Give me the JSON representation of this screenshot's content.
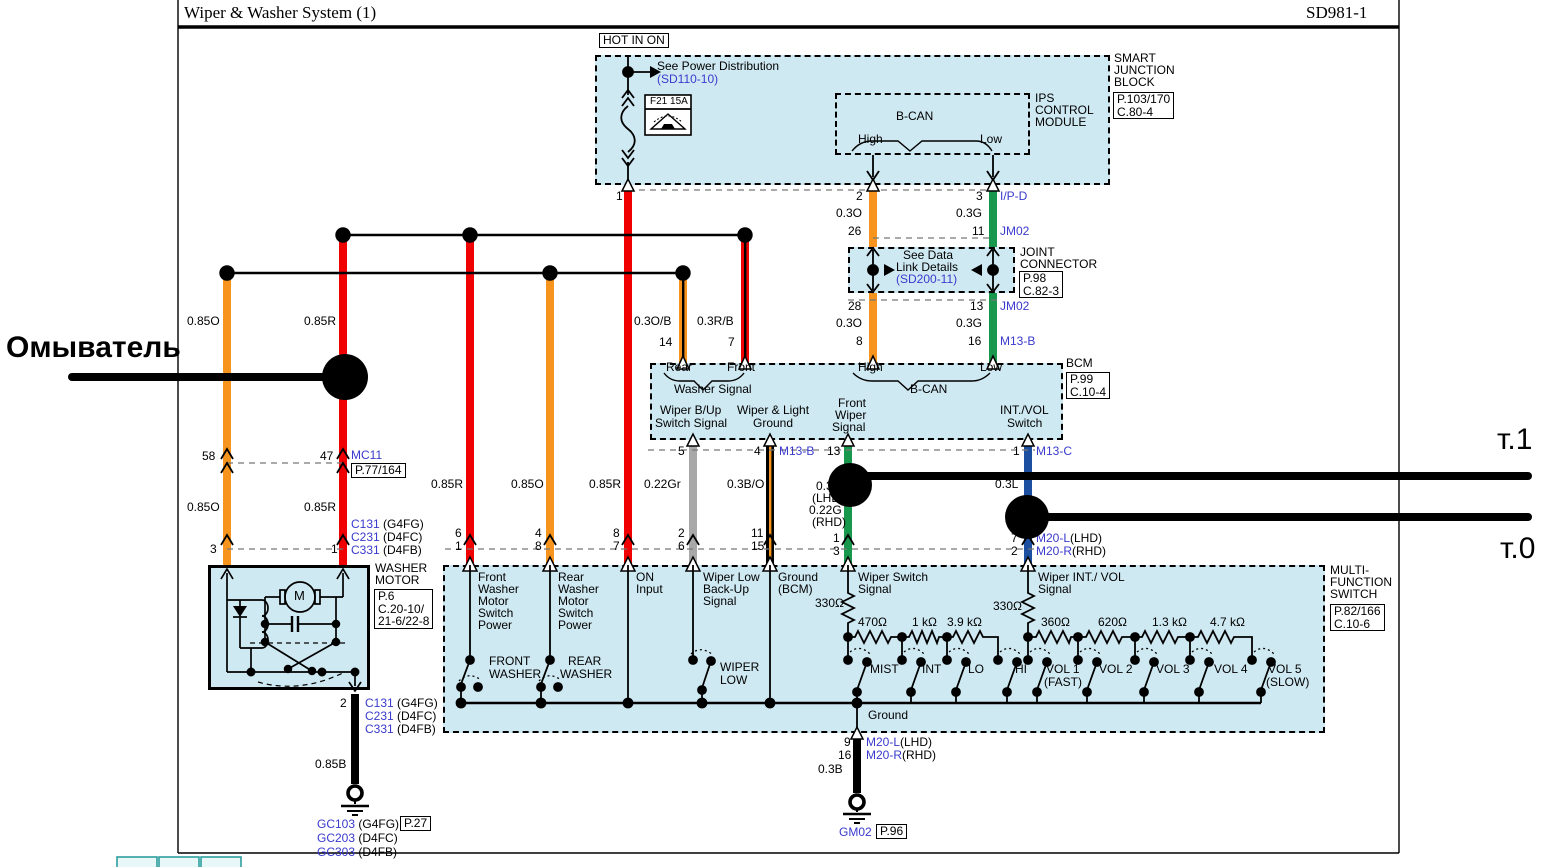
{
  "title": {
    "left": "Wiper & Washer System (1)",
    "right": "SD981-1"
  },
  "colors": {
    "wire_red": "#f00000",
    "wire_orange": "#f7941d",
    "wire_green": "#17984c",
    "wire_blue": "#1d4fa1",
    "wire_gray": "#a8a8a8",
    "wire_black": "#000000",
    "module_fill": "#cfe9f2",
    "link_blue": "#3a3acd",
    "annotation_black": "#000000",
    "teal_tab": "#2f9e9e"
  },
  "labels": [
    {
      "name": "washer-annotation",
      "text": "Омыватель",
      "x": 6,
      "y": 332,
      "size": 30,
      "bold": true
    },
    {
      "name": "t1-annotation",
      "text": "т.1",
      "x": 1497,
      "y": 424,
      "size": 30
    },
    {
      "name": "t0-annotation",
      "text": "т.0",
      "x": 1500,
      "y": 533,
      "size": 30
    },
    {
      "name": "hot-in-on-label",
      "text": "HOT IN ON",
      "x": 599,
      "y": 33,
      "boxed": true
    },
    {
      "name": "see-power-distribution",
      "text": "See Power Distribution",
      "x": 657,
      "y": 60
    },
    {
      "name": "see-power-ref",
      "text": "(SD110-10)",
      "x": 657,
      "y": 73,
      "color": "blue"
    },
    {
      "name": "fuse-label",
      "text": "F21 15A",
      "x": 650,
      "y": 97,
      "size": 10
    },
    {
      "name": "sjb-name-1",
      "text": "SMART",
      "x": 1114,
      "y": 52
    },
    {
      "name": "sjb-name-2",
      "text": "JUNCTION",
      "x": 1114,
      "y": 64
    },
    {
      "name": "sjb-name-3",
      "text": "BLOCK",
      "x": 1114,
      "y": 76
    },
    {
      "name": "sjb-ref",
      "lines": [
        "P.103/170",
        "C.80-4"
      ],
      "x": 1113,
      "y": 92,
      "boxed": true
    },
    {
      "name": "ips-name-1",
      "text": "IPS",
      "x": 1035,
      "y": 92
    },
    {
      "name": "ips-name-2",
      "text": "CONTROL",
      "x": 1035,
      "y": 104
    },
    {
      "name": "ips-name-3",
      "text": "MODULE",
      "x": 1035,
      "y": 116
    },
    {
      "name": "bcan-top",
      "text": "B-CAN",
      "x": 896,
      "y": 110
    },
    {
      "name": "high-top",
      "text": "High",
      "x": 858,
      "y": 133
    },
    {
      "name": "low-top",
      "text": "Low",
      "x": 980,
      "y": 133
    },
    {
      "name": "pin",
      "text": "1",
      "x": 616,
      "y": 190
    },
    {
      "name": "pin",
      "text": "2",
      "x": 856,
      "y": 190
    },
    {
      "name": "wire-label",
      "text": "0.3O",
      "x": 836,
      "y": 207
    },
    {
      "name": "pin",
      "text": "26",
      "x": 848,
      "y": 225
    },
    {
      "name": "pin",
      "text": "3",
      "x": 976,
      "y": 190
    },
    {
      "name": "connector-ref",
      "text": "I/P-D",
      "x": 1000,
      "y": 190,
      "color": "blue"
    },
    {
      "name": "wire-label",
      "text": "0.3G",
      "x": 956,
      "y": 207
    },
    {
      "name": "pin",
      "text": "11",
      "x": 972,
      "y": 225
    },
    {
      "name": "connector-ref",
      "text": "JM02",
      "x": 1000,
      "y": 225,
      "color": "blue"
    },
    {
      "name": "jc-text-1",
      "text": "See Data",
      "x": 903,
      "y": 249
    },
    {
      "name": "jc-text-2",
      "text": "Link Details",
      "x": 896,
      "y": 261
    },
    {
      "name": "jc-ref-link",
      "text": "(SD200-11)",
      "x": 896,
      "y": 273,
      "color": "blue"
    },
    {
      "name": "jc-name-1",
      "text": "JOINT",
      "x": 1020,
      "y": 246
    },
    {
      "name": "jc-name-2",
      "text": "CONNECTOR",
      "x": 1020,
      "y": 258
    },
    {
      "name": "jc-ref",
      "lines": [
        "P.98",
        "C.82-3"
      ],
      "x": 1019,
      "y": 271,
      "boxed": true
    },
    {
      "name": "pin",
      "text": "28",
      "x": 848,
      "y": 300
    },
    {
      "name": "wire-label",
      "text": "0.3O",
      "x": 836,
      "y": 317
    },
    {
      "name": "pin",
      "text": "8",
      "x": 856,
      "y": 335
    },
    {
      "name": "pin",
      "text": "13",
      "x": 970,
      "y": 300
    },
    {
      "name": "connector-ref",
      "text": "JM02",
      "x": 1000,
      "y": 300,
      "color": "blue"
    },
    {
      "name": "wire-label",
      "text": "0.3G",
      "x": 956,
      "y": 317
    },
    {
      "name": "pin",
      "text": "16",
      "x": 968,
      "y": 335
    },
    {
      "name": "connector-ref",
      "text": "M13-B",
      "x": 1000,
      "y": 335,
      "color": "blue"
    },
    {
      "name": "wire-label",
      "text": "0.85O",
      "x": 187,
      "y": 315
    },
    {
      "name": "wire-label",
      "text": "0.85R",
      "x": 304,
      "y": 315
    },
    {
      "name": "pin",
      "text": "58",
      "x": 202,
      "y": 450
    },
    {
      "name": "pin",
      "text": "47",
      "x": 320,
      "y": 450
    },
    {
      "name": "connector-ref",
      "text": "MC11",
      "x": 351,
      "y": 449,
      "color": "blue"
    },
    {
      "name": "connector-page-ref",
      "lines": [
        "P.77/164"
      ],
      "x": 351,
      "y": 463,
      "boxed": true
    },
    {
      "name": "wire-label",
      "text": "0.85O",
      "x": 187,
      "y": 501
    },
    {
      "name": "wire-label",
      "text": "0.85R",
      "x": 304,
      "y": 501
    },
    {
      "name": "pin",
      "text": "3",
      "x": 210,
      "y": 543
    },
    {
      "name": "pin",
      "text": "1",
      "x": 331,
      "y": 543
    },
    {
      "name": "connector-row",
      "parts": [
        {
          "t": "C131",
          "c": "blue"
        },
        {
          "t": " (G4FG)",
          "c": "black"
        }
      ],
      "x": 351,
      "y": 518
    },
    {
      "name": "connector-row",
      "parts": [
        {
          "t": "C231",
          "c": "blue"
        },
        {
          "t": " (D4FC)",
          "c": "black"
        }
      ],
      "x": 351,
      "y": 531
    },
    {
      "name": "connector-row",
      "parts": [
        {
          "t": "C331",
          "c": "blue"
        },
        {
          "t": " (D4FB)",
          "c": "black"
        }
      ],
      "x": 351,
      "y": 544
    },
    {
      "name": "washer-motor-name-1",
      "text": "WASHER",
      "x": 375,
      "y": 562
    },
    {
      "name": "washer-motor-name-2",
      "text": "MOTOR",
      "x": 375,
      "y": 574
    },
    {
      "name": "washer-motor-ref",
      "lines": [
        "P.6",
        "C.20-10/",
        "21-6/22-8"
      ],
      "x": 374,
      "y": 589,
      "boxed": true
    },
    {
      "name": "motor-m",
      "text": "M",
      "x": 294,
      "y": 589,
      "size": 13
    },
    {
      "name": "pin",
      "text": "2",
      "x": 340,
      "y": 697
    },
    {
      "name": "connector-row",
      "parts": [
        {
          "t": "C131",
          "c": "blue"
        },
        {
          "t": " (G4FG)",
          "c": "black"
        }
      ],
      "x": 365,
      "y": 697
    },
    {
      "name": "connector-row",
      "parts": [
        {
          "t": "C231",
          "c": "blue"
        },
        {
          "t": " (D4FC)",
          "c": "black"
        }
      ],
      "x": 365,
      "y": 710
    },
    {
      "name": "connector-row",
      "parts": [
        {
          "t": "C331",
          "c": "blue"
        },
        {
          "t": " (D4FB)",
          "c": "black"
        }
      ],
      "x": 365,
      "y": 723
    },
    {
      "name": "wire-label",
      "text": "0.85B",
      "x": 315,
      "y": 758
    },
    {
      "name": "ground-row",
      "parts": [
        {
          "t": "GC103",
          "c": "blue"
        },
        {
          "t": " (G4FG)",
          "c": "black"
        }
      ],
      "x": 317,
      "y": 818
    },
    {
      "name": "ground-page-ref",
      "lines": [
        "P.27"
      ],
      "x": 400,
      "y": 816,
      "boxed": true
    },
    {
      "name": "ground-row",
      "parts": [
        {
          "t": "GC203",
          "c": "blue"
        },
        {
          "t": " (D4FC)",
          "c": "black"
        }
      ],
      "x": 317,
      "y": 832
    },
    {
      "name": "ground-row",
      "parts": [
        {
          "t": "GC303",
          "c": "blue"
        },
        {
          "t": " (D4FB)",
          "c": "black"
        }
      ],
      "x": 317,
      "y": 846
    },
    {
      "name": "wire-label",
      "text": "0.85R",
      "x": 431,
      "y": 478
    },
    {
      "name": "wire-label",
      "text": "0.85O",
      "x": 511,
      "y": 478
    },
    {
      "name": "wire-label",
      "text": "0.85R",
      "x": 589,
      "y": 478
    },
    {
      "name": "wire-label",
      "text": "0.22Gr",
      "x": 644,
      "y": 478
    },
    {
      "name": "wire-label",
      "text": "0.3B/O",
      "x": 727,
      "y": 478
    },
    {
      "name": "pin",
      "text": "6",
      "x": 455,
      "y": 527
    },
    {
      "name": "pin",
      "text": "1",
      "x": 455,
      "y": 540
    },
    {
      "name": "pin",
      "text": "4",
      "x": 535,
      "y": 527
    },
    {
      "name": "pin",
      "text": "8",
      "x": 535,
      "y": 540
    },
    {
      "name": "pin",
      "text": "8",
      "x": 613,
      "y": 527
    },
    {
      "name": "pin",
      "text": "7",
      "x": 613,
      "y": 540
    },
    {
      "name": "pin",
      "text": "2",
      "x": 678,
      "y": 527
    },
    {
      "name": "pin",
      "text": "6",
      "x": 678,
      "y": 540
    },
    {
      "name": "pin",
      "text": "11",
      "x": 751,
      "y": 527
    },
    {
      "name": "pin",
      "text": "15",
      "x": 751,
      "y": 540
    },
    {
      "name": "pin",
      "text": "5",
      "x": 678,
      "y": 445
    },
    {
      "name": "pin",
      "text": "4",
      "x": 754,
      "y": 445
    },
    {
      "name": "connector-ref",
      "text": "M13-B",
      "x": 779,
      "y": 445,
      "color": "blue"
    },
    {
      "name": "pin",
      "text": "13",
      "x": 827,
      "y": 445
    },
    {
      "name": "pin",
      "text": "1",
      "x": 1013,
      "y": 445
    },
    {
      "name": "connector-ref",
      "text": "M13-C",
      "x": 1036,
      "y": 445,
      "color": "blue"
    },
    {
      "name": "wire-label",
      "text": "0.3G",
      "x": 816,
      "y": 480
    },
    {
      "name": "wire-label",
      "text": "(LHD)",
      "x": 812,
      "y": 492
    },
    {
      "name": "wire-label",
      "text": "0.22G",
      "x": 809,
      "y": 504
    },
    {
      "name": "wire-label",
      "text": "(RHD)",
      "x": 812,
      "y": 516
    },
    {
      "name": "pin",
      "text": "1",
      "x": 833,
      "y": 532
    },
    {
      "name": "pin",
      "text": "3",
      "x": 833,
      "y": 545
    },
    {
      "name": "wire-label",
      "text": "0.3L",
      "x": 995,
      "y": 478
    },
    {
      "name": "pin",
      "text": "7",
      "x": 1011,
      "y": 532
    },
    {
      "name": "pin",
      "text": "2",
      "x": 1011,
      "y": 545
    },
    {
      "name": "connector-row",
      "parts": [
        {
          "t": "M20-L",
          "c": "blue"
        },
        {
          "t": "(LHD)",
          "c": "black"
        }
      ],
      "x": 1036,
      "y": 532
    },
    {
      "name": "connector-row",
      "parts": [
        {
          "t": "M20-R",
          "c": "blue"
        },
        {
          "t": "(RHD)",
          "c": "black"
        }
      ],
      "x": 1036,
      "y": 545
    },
    {
      "name": "wire-label",
      "text": "0.3O/B",
      "x": 634,
      "y": 315
    },
    {
      "name": "pin",
      "text": "14",
      "x": 659,
      "y": 336
    },
    {
      "name": "wire-label",
      "text": "0.3R/B",
      "x": 697,
      "y": 315
    },
    {
      "name": "pin",
      "text": "7",
      "x": 728,
      "y": 336
    },
    {
      "name": "bcm-rear",
      "text": "Rear",
      "x": 666,
      "y": 361
    },
    {
      "name": "bcm-front",
      "text": "Front",
      "x": 727,
      "y": 361
    },
    {
      "name": "bcm-washer-signal",
      "text": "Washer Signal",
      "x": 674,
      "y": 383
    },
    {
      "name": "bcm-high",
      "text": "High",
      "x": 858,
      "y": 361
    },
    {
      "name": "bcm-low",
      "text": "Low",
      "x": 980,
      "y": 361
    },
    {
      "name": "bcm-bcan",
      "text": "B-CAN",
      "x": 910,
      "y": 383
    },
    {
      "name": "bcm-io",
      "text": "Wiper B/Up",
      "x": 660,
      "y": 404
    },
    {
      "name": "bcm-io",
      "text": "Switch Signal",
      "x": 655,
      "y": 417
    },
    {
      "name": "bcm-io",
      "text": "Wiper & Light",
      "x": 737,
      "y": 404
    },
    {
      "name": "bcm-io",
      "text": "Ground",
      "x": 753,
      "y": 417
    },
    {
      "name": "bcm-io",
      "text": "Front",
      "x": 838,
      "y": 397
    },
    {
      "name": "bcm-io",
      "text": "Wiper",
      "x": 835,
      "y": 409
    },
    {
      "name": "bcm-io",
      "text": "Signal",
      "x": 832,
      "y": 421
    },
    {
      "name": "bcm-io",
      "text": "INT./VOL",
      "x": 1000,
      "y": 404
    },
    {
      "name": "bcm-io",
      "text": "Switch",
      "x": 1007,
      "y": 417
    },
    {
      "name": "bcm-name",
      "text": "BCM",
      "x": 1066,
      "y": 357
    },
    {
      "name": "bcm-ref",
      "lines": [
        "P.99",
        "C.10-4"
      ],
      "x": 1066,
      "y": 372,
      "boxed": true
    },
    {
      "name": "mfs-col",
      "text": "Front",
      "x": 478,
      "y": 571
    },
    {
      "name": "mfs-col",
      "text": "Washer",
      "x": 478,
      "y": 583
    },
    {
      "name": "mfs-col",
      "text": "Motor",
      "x": 478,
      "y": 595
    },
    {
      "name": "mfs-col",
      "text": "Switch",
      "x": 478,
      "y": 607
    },
    {
      "name": "mfs-col",
      "text": "Power",
      "x": 478,
      "y": 619
    },
    {
      "name": "mfs-col",
      "text": "Rear",
      "x": 558,
      "y": 571
    },
    {
      "name": "mfs-col",
      "text": "Washer",
      "x": 558,
      "y": 583
    },
    {
      "name": "mfs-col",
      "text": "Motor",
      "x": 558,
      "y": 595
    },
    {
      "name": "mfs-col",
      "text": "Switch",
      "x": 558,
      "y": 607
    },
    {
      "name": "mfs-col",
      "text": "Power",
      "x": 558,
      "y": 619
    },
    {
      "name": "mfs-col",
      "text": "ON",
      "x": 636,
      "y": 571
    },
    {
      "name": "mfs-col",
      "text": "Input",
      "x": 636,
      "y": 583
    },
    {
      "name": "mfs-col",
      "text": "Wiper Low",
      "x": 703,
      "y": 571
    },
    {
      "name": "mfs-col",
      "text": "Back-Up",
      "x": 703,
      "y": 583
    },
    {
      "name": "mfs-col",
      "text": "Signal",
      "x": 703,
      "y": 595
    },
    {
      "name": "mfs-col",
      "text": "Ground",
      "x": 778,
      "y": 571
    },
    {
      "name": "mfs-col",
      "text": "(BCM)",
      "x": 778,
      "y": 583
    },
    {
      "name": "mfs-col",
      "text": "Wiper Switch",
      "x": 858,
      "y": 571
    },
    {
      "name": "mfs-col",
      "text": "Signal",
      "x": 858,
      "y": 583
    },
    {
      "name": "mfs-col",
      "text": "Wiper INT./ VOL",
      "x": 1038,
      "y": 571
    },
    {
      "name": "mfs-col",
      "text": "Signal",
      "x": 1038,
      "y": 583
    },
    {
      "name": "resistor-value",
      "text": "330Ω",
      "x": 815,
      "y": 597
    },
    {
      "name": "resistor-value",
      "text": "330Ω",
      "x": 993,
      "y": 600
    },
    {
      "name": "resistor-value",
      "text": "470Ω",
      "x": 858,
      "y": 616
    },
    {
      "name": "resistor-value",
      "text": "1 kΩ",
      "x": 912,
      "y": 616
    },
    {
      "name": "resistor-value",
      "text": "3.9 kΩ",
      "x": 947,
      "y": 616
    },
    {
      "name": "resistor-value",
      "text": "360Ω",
      "x": 1041,
      "y": 616
    },
    {
      "name": "resistor-value",
      "text": "620Ω",
      "x": 1098,
      "y": 616
    },
    {
      "name": "resistor-value",
      "text": "1.3 kΩ",
      "x": 1152,
      "y": 616
    },
    {
      "name": "resistor-value",
      "text": "4.7 kΩ",
      "x": 1210,
      "y": 616
    },
    {
      "name": "switch-pos",
      "text": "MIST",
      "x": 870,
      "y": 663
    },
    {
      "name": "switch-pos",
      "text": "INT",
      "x": 922,
      "y": 663
    },
    {
      "name": "switch-pos",
      "text": "LO",
      "x": 968,
      "y": 663
    },
    {
      "name": "switch-pos",
      "text": "HI",
      "x": 1015,
      "y": 663
    },
    {
      "name": "switch-pos",
      "text": "VOL 1",
      "x": 1046,
      "y": 663
    },
    {
      "name": "switch-pos",
      "text": "(FAST)",
      "x": 1044,
      "y": 676
    },
    {
      "name": "switch-pos",
      "text": "VOL 2",
      "x": 1099,
      "y": 663
    },
    {
      "name": "switch-pos",
      "text": "VOL 3",
      "x": 1156,
      "y": 663
    },
    {
      "name": "switch-pos",
      "text": "VOL 4",
      "x": 1214,
      "y": 663
    },
    {
      "name": "switch-pos",
      "text": "VOL 5",
      "x": 1268,
      "y": 663
    },
    {
      "name": "switch-pos",
      "text": "(SLOW)",
      "x": 1266,
      "y": 676
    },
    {
      "name": "switch-pos",
      "text": "FRONT",
      "x": 489,
      "y": 655
    },
    {
      "name": "switch-pos",
      "text": "WASHER",
      "x": 489,
      "y": 668
    },
    {
      "name": "switch-pos",
      "text": "REAR",
      "x": 568,
      "y": 655
    },
    {
      "name": "switch-pos",
      "text": "WASHER",
      "x": 560,
      "y": 668
    },
    {
      "name": "switch-pos",
      "text": "WIPER",
      "x": 720,
      "y": 661
    },
    {
      "name": "switch-pos",
      "text": "LOW",
      "x": 720,
      "y": 674
    },
    {
      "name": "mfs-ground",
      "text": "Ground",
      "x": 868,
      "y": 709
    },
    {
      "name": "mfs-name-1",
      "text": "MULTI-",
      "x": 1330,
      "y": 564
    },
    {
      "name": "mfs-name-2",
      "text": "FUNCTION",
      "x": 1330,
      "y": 576
    },
    {
      "name": "mfs-name-3",
      "text": "SWITCH",
      "x": 1330,
      "y": 588
    },
    {
      "name": "mfs-ref",
      "lines": [
        "P.82/166",
        "C.10-6"
      ],
      "x": 1330,
      "y": 604,
      "boxed": true
    },
    {
      "name": "pin",
      "text": "9",
      "x": 844,
      "y": 736
    },
    {
      "name": "pin",
      "text": "16",
      "x": 838,
      "y": 749
    },
    {
      "name": "connector-row",
      "parts": [
        {
          "t": "M20-L",
          "c": "blue"
        },
        {
          "t": "(LHD)",
          "c": "black"
        }
      ],
      "x": 866,
      "y": 736
    },
    {
      "name": "connector-row",
      "parts": [
        {
          "t": "M20-R",
          "c": "blue"
        },
        {
          "t": "(RHD)",
          "c": "black"
        }
      ],
      "x": 866,
      "y": 749
    },
    {
      "name": "wire-label",
      "text": "0.3B",
      "x": 818,
      "y": 763
    },
    {
      "name": "ground-ref",
      "text": "GM02",
      "x": 839,
      "y": 826,
      "color": "blue"
    },
    {
      "name": "ground-page-ref",
      "lines": [
        "P.96"
      ],
      "x": 876,
      "y": 824,
      "boxed": true
    }
  ]
}
